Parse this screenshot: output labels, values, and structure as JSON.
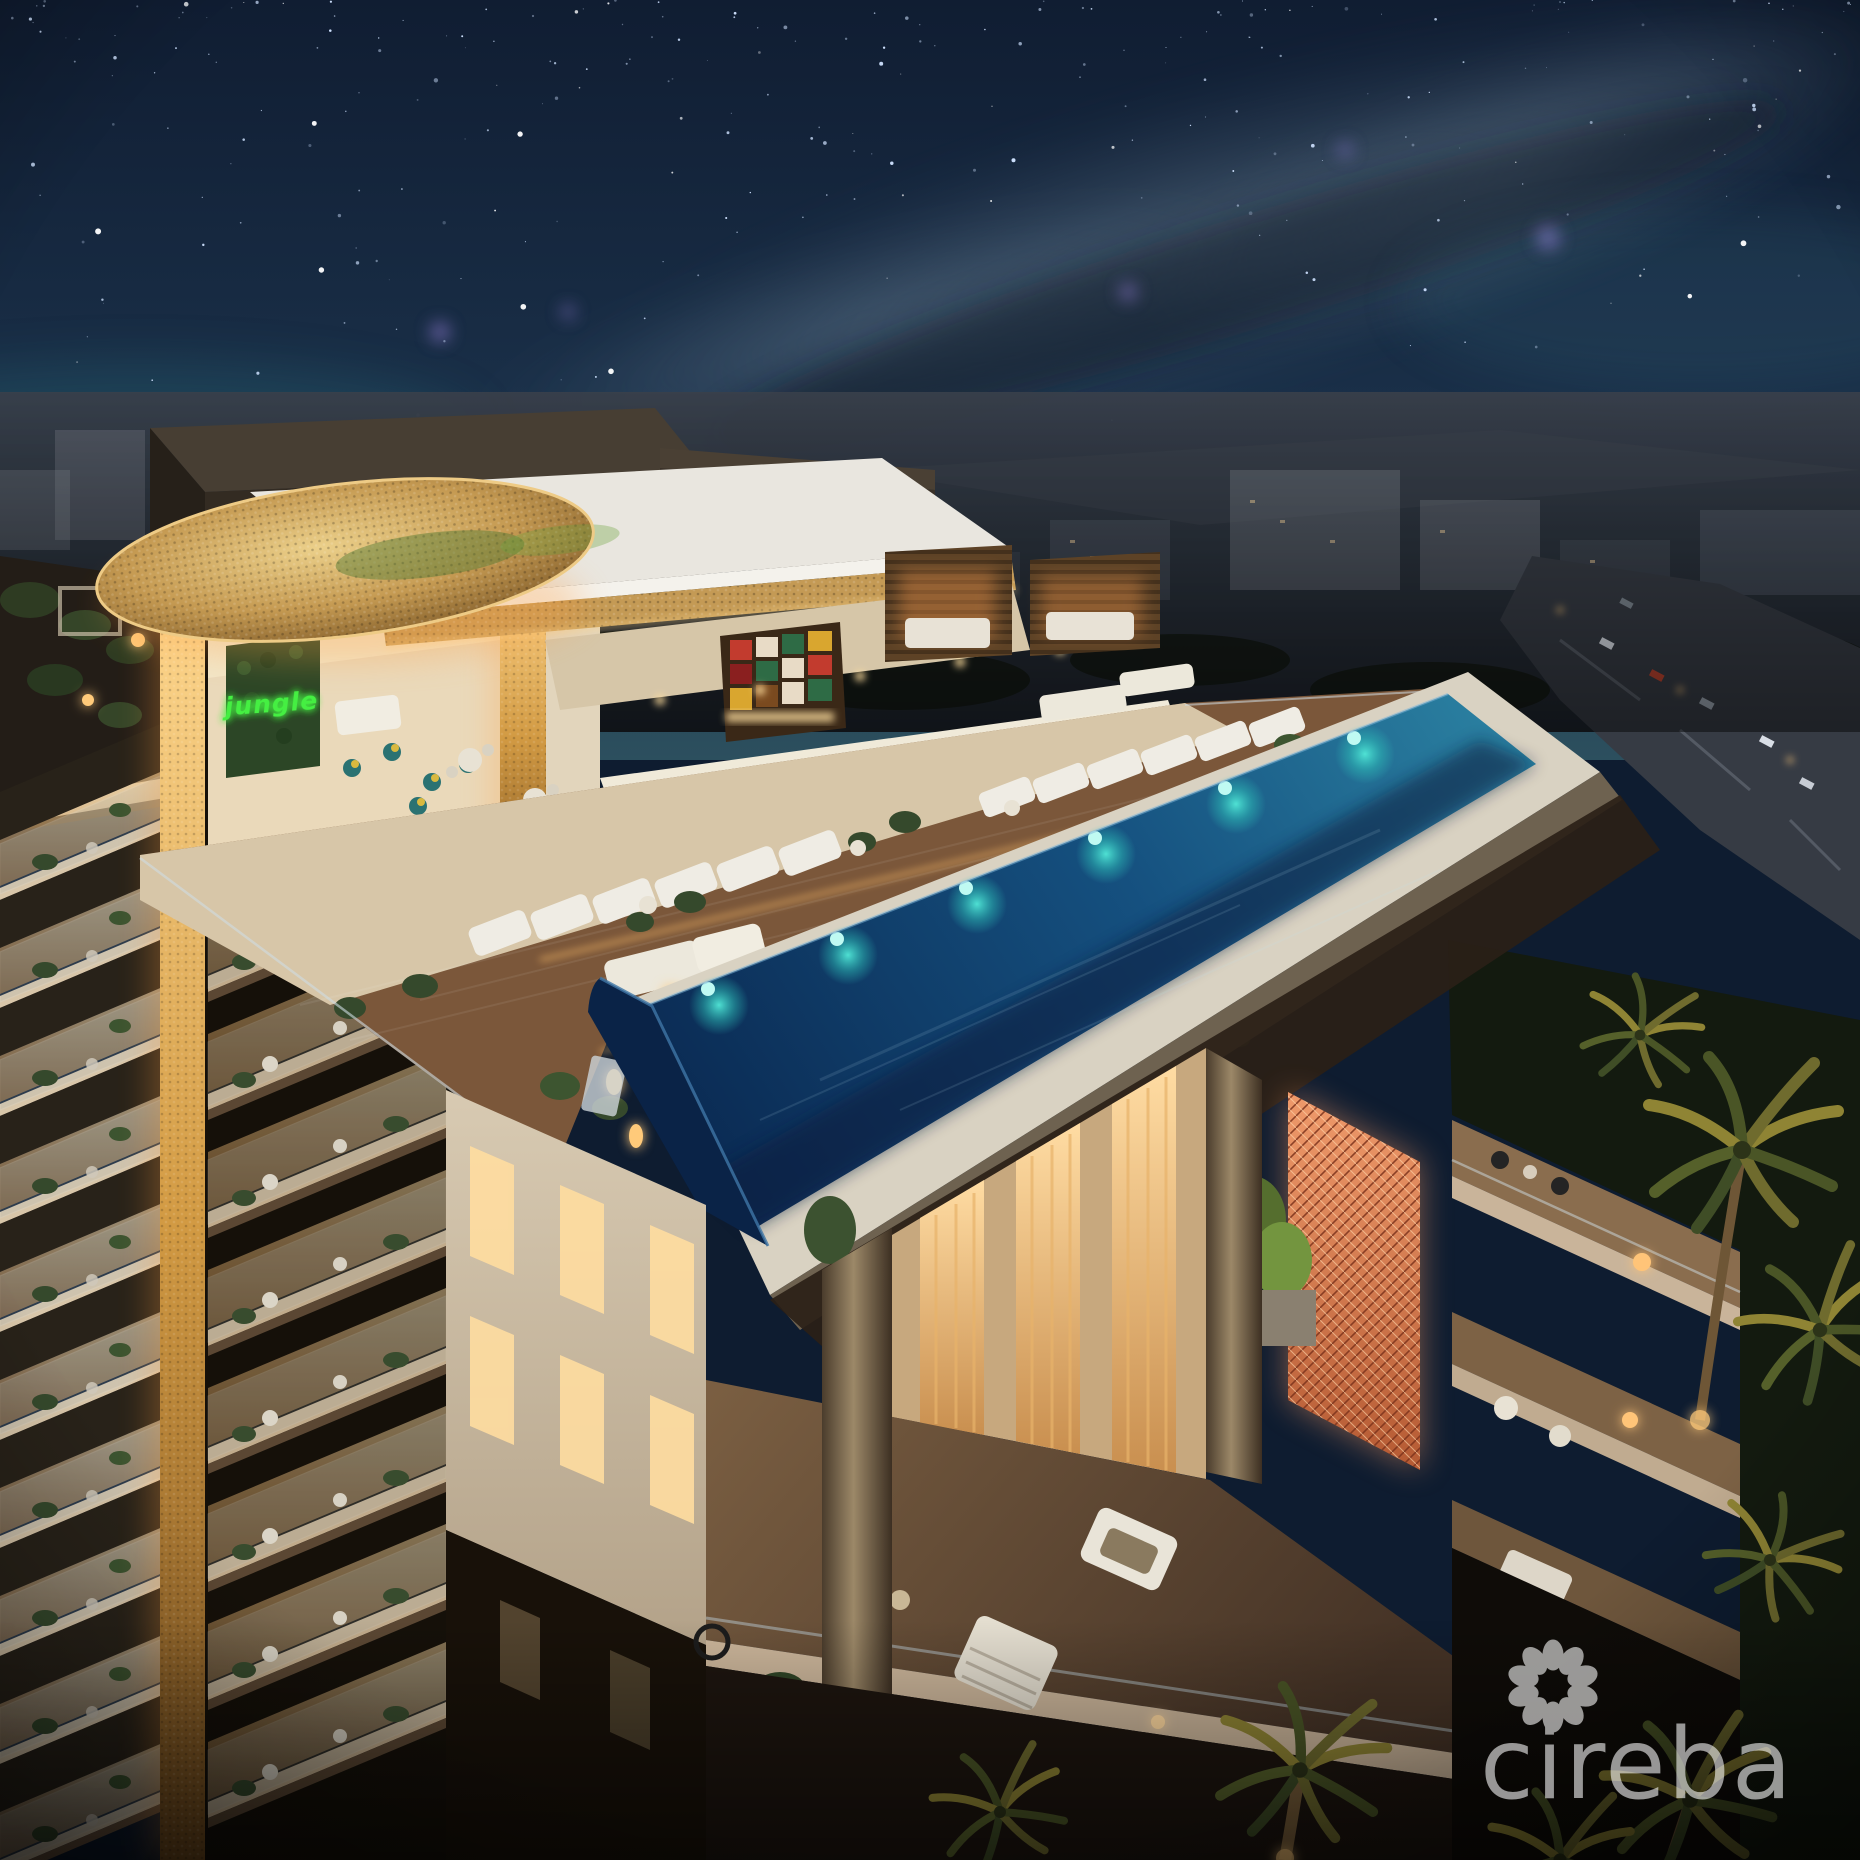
{
  "scene": {
    "type": "night architectural rendering of a luxury condo tower with rooftop bar and infinity pool",
    "neon_sign": {
      "text": "jungle",
      "color": "#45ef42"
    },
    "watermark": {
      "text": "cireba",
      "color": "#ffffff",
      "opacity": 0.55,
      "icon": "petal-ring-flower-icon",
      "petals": 10
    }
  },
  "sky": {
    "star_count": 250
  },
  "palette": {
    "sky_top": "#101d32",
    "sky_mid": "#1a3049",
    "sky_horizon": "#2c4f5e",
    "star": "#cfe2ff",
    "nebula": "#9b82e0",
    "milky_way": "#aec6d6",
    "city_base": "#39404b",
    "city_dark": "#1d222a",
    "road": "#363b44",
    "stone_dark": "#2e281f",
    "stone_face": "#473e33",
    "roof_white": "#e9e6df",
    "gold_light": "#ffd88f",
    "gold_mid": "#d29a43",
    "gold_deep": "#7c5220",
    "amber_glow": "#ffb35c",
    "warm_window": "#ffdfa8",
    "cream_wall": "#d8cab2",
    "wall_shade": "#b3a289",
    "tile_floor": "#d7c6a8",
    "wood_deck": "#7b573a",
    "pool_deep": "#0b2c55",
    "pool_mid": "#15507f",
    "pool_bright": "#2a7fa0",
    "pool_wall": "#0a2347",
    "pool_light_teal": "#52e8d8",
    "rim_white": "#d9d2c2",
    "glass": "#cfdde3",
    "plant_dark": "#35492c",
    "plant_lit": "#73953f",
    "palm_gold": "#8f8434",
    "teal_seat": "#1f6065",
    "cushion_yellow": "#d9b93f",
    "copper_screen": "#ef9a6b",
    "shelf_red": "#c23b2e",
    "shelf_green": "#2e6b45",
    "shelf_amber": "#d9a62f",
    "lounger_white": "#efece4",
    "terrace_floor": "#7b5f42",
    "night_ground": "#131a0f"
  }
}
